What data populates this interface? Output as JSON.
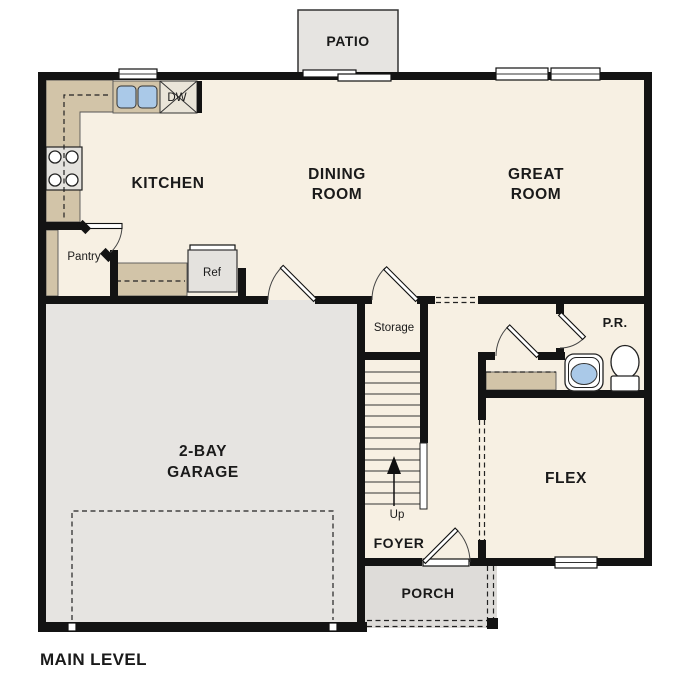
{
  "plan_title": "MAIN LEVEL",
  "labels": {
    "patio": "PATIO",
    "kitchen": "KITCHEN",
    "dining_line1": "DINING",
    "dining_line2": "ROOM",
    "great_line1": "GREAT",
    "great_line2": "ROOM",
    "garage_line1": "2-BAY",
    "garage_line2": "GARAGE",
    "flex": "FLEX",
    "foyer": "FOYER",
    "porch": "PORCH",
    "powder_room": "P.R.",
    "storage": "Storage",
    "pantry": "Pantry",
    "refrigerator": "Ref",
    "dishwasher": "DW",
    "stairs_up": "Up"
  },
  "colors": {
    "wall": "#131313",
    "floor": "#f7f0e3",
    "garage_floor": "#e6e4e1",
    "porch_floor": "#dedcd9",
    "patio_floor": "#e6e4e1",
    "counter": "#d2c4a8",
    "appliance": "#e4e2de",
    "dishwasher_box": "#eae5d9",
    "sink": "#aac9e8"
  }
}
